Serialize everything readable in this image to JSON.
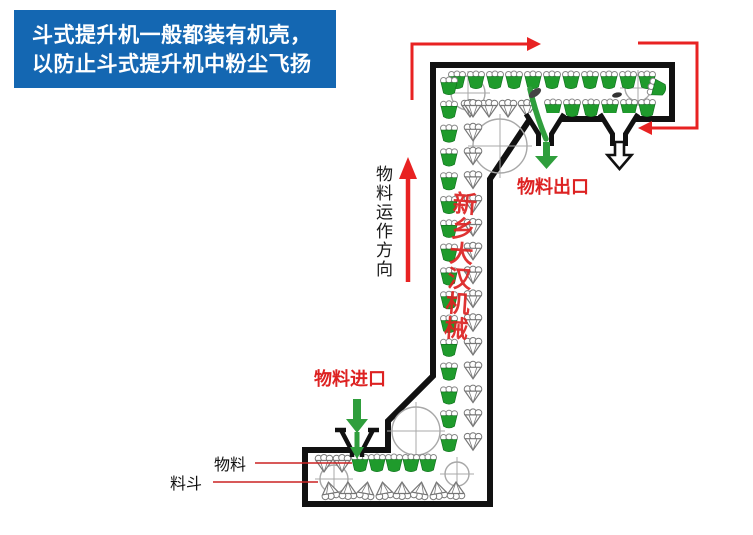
{
  "banner": {
    "line1": "斗式提升机一般都装有机壳，",
    "line2": "以防止斗式提升机中粉尘飞扬",
    "bg_color": "#1467b2"
  },
  "diagram": {
    "direction_label": "物料运作方向",
    "outlet_label": "物料出口",
    "inlet_label": "物料进口",
    "material_label": "物料",
    "bucket_label": "料斗",
    "watermark": "新乡大汉机械",
    "colors": {
      "bucket_green": "#1f9b2c",
      "casing_black": "#111111",
      "outline_grey": "#777777",
      "pulley_grey": "#a8a8a8",
      "arrow_red": "#e82222",
      "label_red": "#dd2222",
      "arrow_green": "#2f9e3c",
      "leader_red": "#cc2222"
    }
  }
}
